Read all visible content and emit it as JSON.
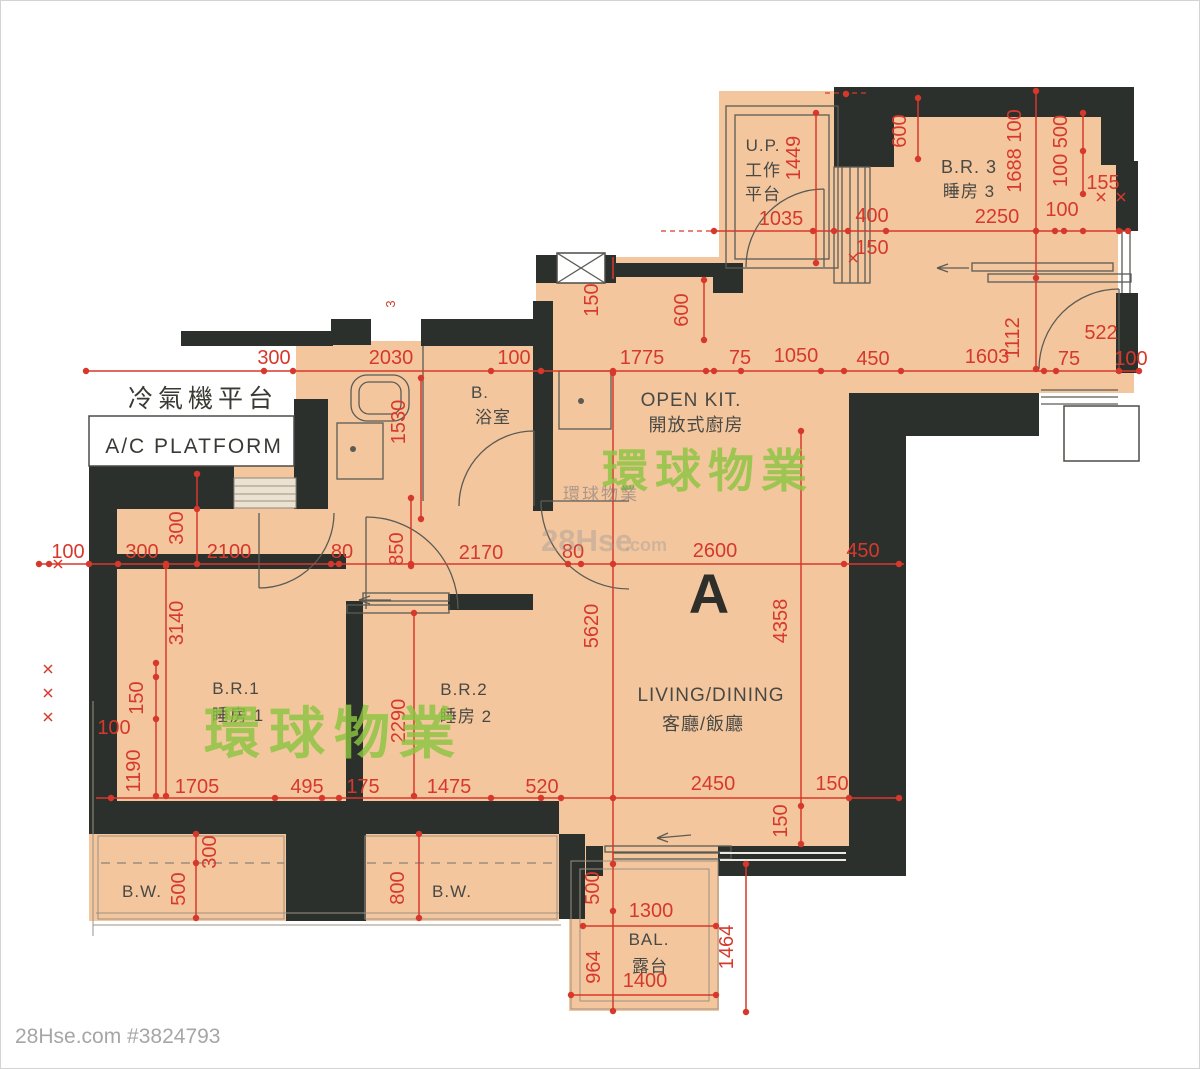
{
  "meta": {
    "unit_label": "A",
    "footer": "28Hse.com #3824793"
  },
  "watermarks": {
    "brand": "環球物業",
    "brand_small": "環球物業",
    "site_name": "28Hse",
    "site_tld": ".com"
  },
  "rooms": {
    "up": {
      "l1": "U.P.",
      "l2": "工作",
      "l3": "平台"
    },
    "br3": {
      "en": "B.R. 3",
      "zh": "睡房 3"
    },
    "kitchen": {
      "en": "OPEN KIT.",
      "zh": "開放式廚房"
    },
    "bath": {
      "en": "B.",
      "zh": "浴室"
    },
    "ac": {
      "zh": "冷氣機平台",
      "en": "A/C PLATFORM"
    },
    "br1": {
      "en": "B.R.1",
      "zh": "睡房 1"
    },
    "br2": {
      "en": "B.R.2",
      "zh": "睡房 2"
    },
    "living": {
      "en": "LIVING/DINING",
      "zh": "客廳/飯廳"
    },
    "bw_left": "B.W.",
    "bw_right": "B.W.",
    "balcony": {
      "en": "BAL.",
      "zh": "露台"
    }
  },
  "dims": [
    {
      "v": "300",
      "x": 273,
      "y": 363
    },
    {
      "v": "2030",
      "x": 390,
      "y": 363
    },
    {
      "v": "100",
      "x": 513,
      "y": 363
    },
    {
      "v": "1775",
      "x": 641,
      "y": 363
    },
    {
      "v": "75",
      "x": 739,
      "y": 363
    },
    {
      "v": "1050",
      "x": 795,
      "y": 361
    },
    {
      "v": "450",
      "x": 872,
      "y": 364
    },
    {
      "v": "1603",
      "x": 986,
      "y": 362
    },
    {
      "v": "75",
      "x": 1068,
      "y": 364
    },
    {
      "v": "100",
      "x": 1130,
      "y": 364
    },
    {
      "v": "1112",
      "x": 1018,
      "y": 337,
      "r": 1
    },
    {
      "v": "522",
      "x": 1100,
      "y": 338
    },
    {
      "v": "1449",
      "x": 799,
      "y": 157,
      "r": 1
    },
    {
      "v": "1035",
      "x": 780,
      "y": 224
    },
    {
      "v": "400",
      "x": 871,
      "y": 221
    },
    {
      "v": "150",
      "x": 871,
      "y": 253
    },
    {
      "v": "600",
      "x": 905,
      "y": 130,
      "r": 1
    },
    {
      "v": "2250",
      "x": 996,
      "y": 222
    },
    {
      "v": "100",
      "x": 1061,
      "y": 215
    },
    {
      "v": "1688 100",
      "x": 1020,
      "y": 150,
      "r": 1
    },
    {
      "v": "100 500",
      "x": 1066,
      "y": 150,
      "r": 1
    },
    {
      "v": "155",
      "x": 1102,
      "y": 188
    },
    {
      "v": "150",
      "x": 597,
      "y": 299,
      "r": 1
    },
    {
      "v": "600",
      "x": 687,
      "y": 309,
      "r": 1
    },
    {
      "v": "3",
      "x": 394,
      "y": 303,
      "r": 1,
      "s": 1
    },
    {
      "v": "1530",
      "x": 404,
      "y": 421,
      "r": 1
    },
    {
      "v": "100",
      "x": 67,
      "y": 557
    },
    {
      "v": "300",
      "x": 141,
      "y": 557
    },
    {
      "v": "2100",
      "x": 228,
      "y": 557
    },
    {
      "v": "80",
      "x": 341,
      "y": 557
    },
    {
      "v": "850",
      "x": 402,
      "y": 548,
      "r": 1
    },
    {
      "v": "2170",
      "x": 480,
      "y": 558
    },
    {
      "v": "80",
      "x": 572,
      "y": 557
    },
    {
      "v": "2600",
      "x": 714,
      "y": 556
    },
    {
      "v": "450",
      "x": 862,
      "y": 556
    },
    {
      "v": "300",
      "x": 182,
      "y": 527,
      "r": 1
    },
    {
      "v": "3140",
      "x": 182,
      "y": 622,
      "r": 1
    },
    {
      "v": "150",
      "x": 142,
      "y": 697,
      "r": 1
    },
    {
      "v": "100",
      "x": 113,
      "y": 733
    },
    {
      "v": "1190",
      "x": 139,
      "y": 770,
      "r": 1
    },
    {
      "v": "5620",
      "x": 597,
      "y": 625,
      "r": 1
    },
    {
      "v": "4358",
      "x": 786,
      "y": 620,
      "r": 1
    },
    {
      "v": "2290",
      "x": 404,
      "y": 720,
      "r": 1
    },
    {
      "v": "1705",
      "x": 196,
      "y": 792
    },
    {
      "v": "495",
      "x": 306,
      "y": 792
    },
    {
      "v": "175",
      "x": 362,
      "y": 792
    },
    {
      "v": "1475",
      "x": 448,
      "y": 792
    },
    {
      "v": "520",
      "x": 541,
      "y": 792
    },
    {
      "v": "2450",
      "x": 712,
      "y": 789
    },
    {
      "v": "150",
      "x": 831,
      "y": 789
    },
    {
      "v": "300",
      "x": 215,
      "y": 851,
      "r": 1
    },
    {
      "v": "500",
      "x": 184,
      "y": 888,
      "r": 1
    },
    {
      "v": "800",
      "x": 403,
      "y": 887,
      "r": 1
    },
    {
      "v": "150",
      "x": 786,
      "y": 820,
      "r": 1
    },
    {
      "v": "500",
      "x": 598,
      "y": 887,
      "r": 1
    },
    {
      "v": "964",
      "x": 599,
      "y": 966,
      "r": 1
    },
    {
      "v": "1300",
      "x": 650,
      "y": 916
    },
    {
      "v": "1400",
      "x": 644,
      "y": 986
    },
    {
      "v": "1464",
      "x": 732,
      "y": 946,
      "r": 1
    }
  ]
}
